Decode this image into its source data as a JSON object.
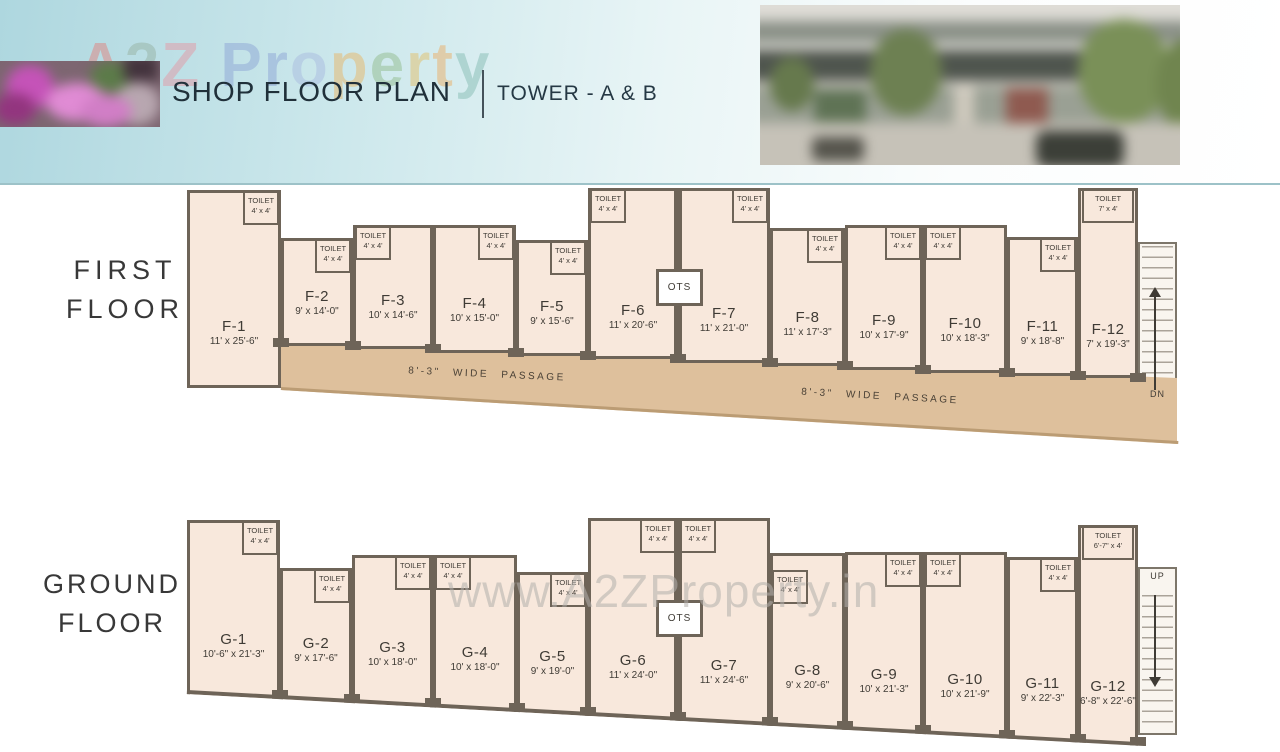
{
  "header": {
    "title": "SHOP FLOOR PLAN",
    "subtitle": "TOWER - A & B",
    "brand_watermark": {
      "text": "A2Z Property",
      "letters": [
        {
          "ch": "A",
          "color": "#e0837f"
        },
        {
          "ch": "2",
          "color": "#97b3a4"
        },
        {
          "ch": "Z",
          "color": "#e39aa6"
        },
        {
          "ch": " ",
          "color": "#ffffff"
        },
        {
          "ch": "P",
          "color": "#8ea6d6"
        },
        {
          "ch": "r",
          "color": "#8ea6d6"
        },
        {
          "ch": "o",
          "color": "#a9bce0"
        },
        {
          "ch": "p",
          "color": "#e7b769"
        },
        {
          "ch": "e",
          "color": "#93bd8e"
        },
        {
          "ch": "r",
          "color": "#e2c06a"
        },
        {
          "ch": "t",
          "color": "#eaaf67"
        },
        {
          "ch": "y",
          "color": "#86bdb4"
        }
      ]
    }
  },
  "site_watermark": "www.A2ZProperty.in",
  "colors": {
    "wall": "#6e6458",
    "room_fill": "#f8e8dc",
    "passage": "#dec09c",
    "passage_edge": "#bb9c74",
    "header_teal": "#aed7df",
    "text": "#3f3b35"
  },
  "floors": [
    {
      "key": "first",
      "name_lines": [
        "FIRST",
        "FLOOR"
      ],
      "ots_label": "OTS",
      "stair_label": "DN",
      "passage_labels": [
        "8'-3\" WIDE PASSAGE",
        "8'-3\" WIDE PASSAGE"
      ],
      "units": [
        {
          "id": "F-1",
          "dims": "11' x 25'-6\"",
          "toilet_label": "TOILET",
          "toilet_size": "4' x 4'"
        },
        {
          "id": "F-2",
          "dims": "9' x 14'-0\"",
          "toilet_label": "TOILET",
          "toilet_size": "4' x 4'"
        },
        {
          "id": "F-3",
          "dims": "10' x 14'-6\"",
          "toilet_label": "TOILET",
          "toilet_size": "4' x 4'"
        },
        {
          "id": "F-4",
          "dims": "10' x 15'-0\"",
          "toilet_label": "TOILET",
          "toilet_size": "4' x 4'"
        },
        {
          "id": "F-5",
          "dims": "9' x 15'-6\"",
          "toilet_label": "TOILET",
          "toilet_size": "4' x 4'"
        },
        {
          "id": "F-6",
          "dims": "11' x 20'-6\"",
          "toilet_label": "TOILET",
          "toilet_size": "4' x 4'"
        },
        {
          "id": "F-7",
          "dims": "11' x 21'-0\"",
          "toilet_label": "TOILET",
          "toilet_size": "4' x 4'"
        },
        {
          "id": "F-8",
          "dims": "11' x 17'-3\"",
          "toilet_label": "TOILET",
          "toilet_size": "4' x 4'"
        },
        {
          "id": "F-9",
          "dims": "10' x 17'-9\"",
          "toilet_label": "TOILET",
          "toilet_size": "4' x 4'"
        },
        {
          "id": "F-10",
          "dims": "10' x 18'-3\"",
          "toilet_label": "TOILET",
          "toilet_size": "4' x 4'"
        },
        {
          "id": "F-11",
          "dims": "9' x 18'-8\"",
          "toilet_label": "TOILET",
          "toilet_size": "4' x 4'"
        },
        {
          "id": "F-12",
          "dims": "7' x 19'-3\"",
          "toilet_label": "TOILET",
          "toilet_size": "7' x 4'"
        }
      ]
    },
    {
      "key": "ground",
      "name_lines": [
        "GROUND",
        "FLOOR"
      ],
      "ots_label": "OTS",
      "stair_label": "UP",
      "passage_labels": [],
      "units": [
        {
          "id": "G-1",
          "dims": "10'-6\" x 21'-3\"",
          "toilet_label": "TOILET",
          "toilet_size": "4' x 4'"
        },
        {
          "id": "G-2",
          "dims": "9' x 17'-6\"",
          "toilet_label": "TOILET",
          "toilet_size": "4' x 4'"
        },
        {
          "id": "G-3",
          "dims": "10' x 18'-0\"",
          "toilet_label": "TOILET",
          "toilet_size": "4' x 4'"
        },
        {
          "id": "G-4",
          "dims": "10' x 18'-0\"",
          "toilet_label": "TOILET",
          "toilet_size": "4' x 4'"
        },
        {
          "id": "G-5",
          "dims": "9' x 19'-0\"",
          "toilet_label": "TOILET",
          "toilet_size": "4' x 4'"
        },
        {
          "id": "G-6",
          "dims": "11' x 24'-0\"",
          "toilet_label": "TOILET",
          "toilet_size": "4' x 4'"
        },
        {
          "id": "G-7",
          "dims": "11' x 24'-6\"",
          "toilet_label": "TOILET",
          "toilet_size": "4' x 4'"
        },
        {
          "id": "G-8",
          "dims": "9' x 20'-6\"",
          "toilet_label": "TOILET",
          "toilet_size": "4' x 4'"
        },
        {
          "id": "G-9",
          "dims": "10' x 21'-3\"",
          "toilet_label": "TOILET",
          "toilet_size": "4' x 4'"
        },
        {
          "id": "G-10",
          "dims": "10' x 21'-9\"",
          "toilet_label": "TOILET",
          "toilet_size": "4' x 4'"
        },
        {
          "id": "G-11",
          "dims": "9' x 22'-3\"",
          "toilet_label": "TOILET",
          "toilet_size": "4' x 4'"
        },
        {
          "id": "G-12",
          "dims": "6'-8\" x 22'-6\"",
          "toilet_label": "TOILET",
          "toilet_size": "6'-7\" x 4'"
        }
      ]
    }
  ]
}
